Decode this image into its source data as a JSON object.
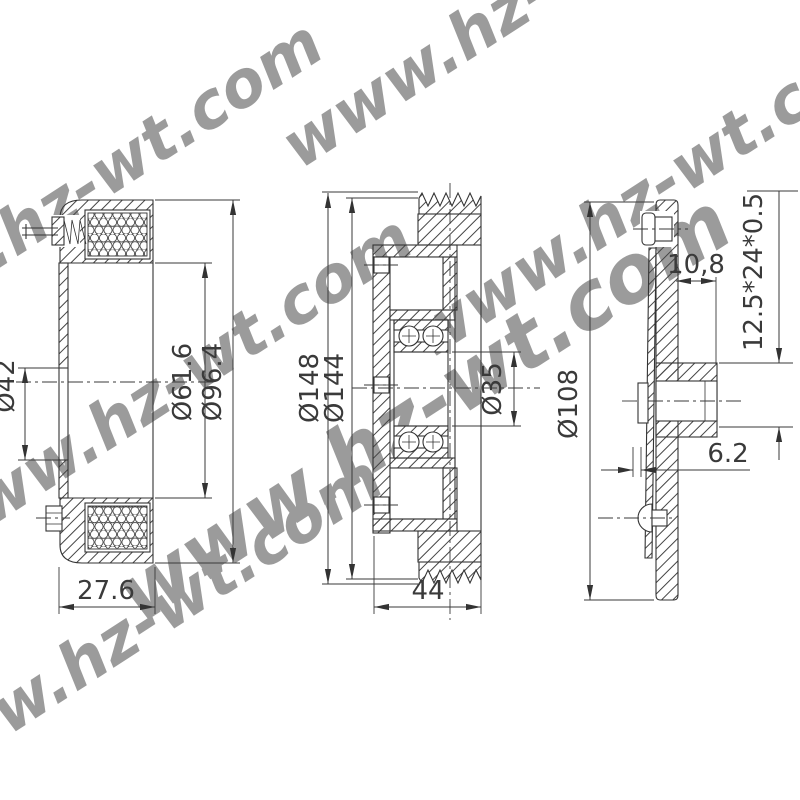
{
  "watermark": {
    "text": "www.hz-wt.com",
    "color": "#74E4DA"
  },
  "ink_color": "#333333",
  "views": {
    "coil": {
      "dims": {
        "inner_bore": "Ø42",
        "winding_od": "Ø61.6",
        "housing_od": "Ø96.4",
        "depth": "27.6"
      }
    },
    "pulley": {
      "dims": {
        "outer_od": "Ø148",
        "groove_od": "Ø144",
        "bearing_bore": "Ø35",
        "width": "44"
      }
    },
    "hub": {
      "dims": {
        "plate_od": "Ø108",
        "hub_offset": "10,8",
        "spline_spec": "12.5*24*0.5",
        "air_gap": "6.2"
      }
    }
  }
}
